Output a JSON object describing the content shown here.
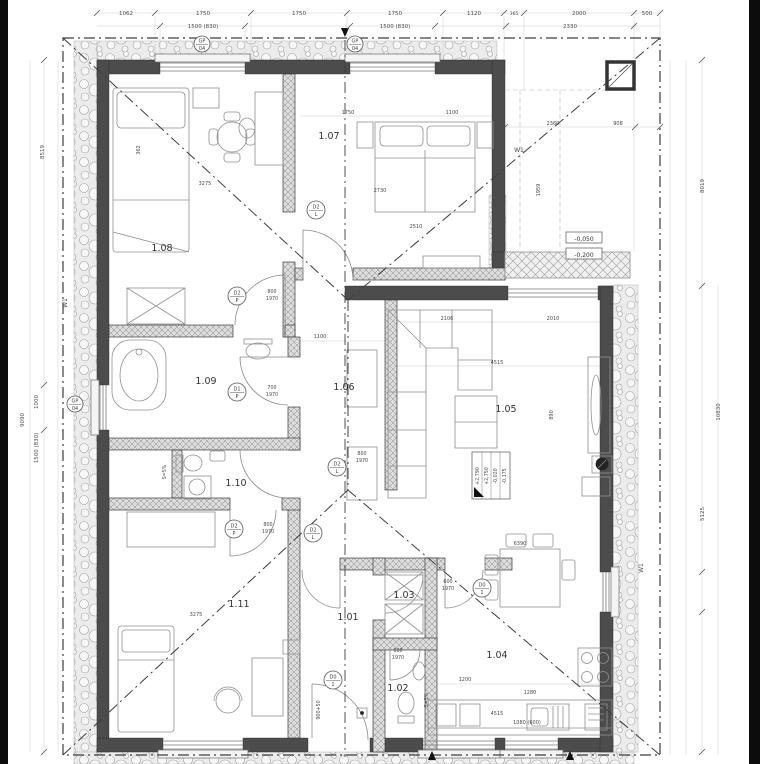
{
  "drawing": {
    "type": "floor-plan",
    "scale_note": ""
  },
  "rooms": [
    {
      "t": "1.01",
      "x": 348,
      "y": 620
    },
    {
      "t": "1.02",
      "x": 398,
      "y": 691
    },
    {
      "t": "1.03",
      "x": 404,
      "y": 598
    },
    {
      "t": "1.04",
      "x": 497,
      "y": 658
    },
    {
      "t": "1.05",
      "x": 506,
      "y": 412
    },
    {
      "t": "1.06",
      "x": 344,
      "y": 390
    },
    {
      "t": "1.07",
      "x": 329,
      "y": 139
    },
    {
      "t": "1.08",
      "x": 162,
      "y": 251
    },
    {
      "t": "1.09",
      "x": 206,
      "y": 384
    },
    {
      "t": "1.10",
      "x": 236,
      "y": 486
    },
    {
      "t": "1.11",
      "x": 239,
      "y": 607
    }
  ],
  "dims": {
    "top1": [
      {
        "t": "1062",
        "x": 126,
        "y": 15
      },
      {
        "t": "1750",
        "x": 203,
        "y": 15
      },
      {
        "t": "1750",
        "x": 299,
        "y": 15
      },
      {
        "t": "1750",
        "x": 395,
        "y": 15
      },
      {
        "t": "1120",
        "x": 474,
        "y": 15
      },
      {
        "t": "365",
        "x": 514,
        "y": 15,
        "fs": 4.5
      },
      {
        "t": "2000",
        "x": 579,
        "y": 15
      },
      {
        "t": "500",
        "x": 647,
        "y": 15
      }
    ],
    "top2": [
      {
        "t": "1500 (830)",
        "x": 203,
        "y": 28
      },
      {
        "t": "1500 (830)",
        "x": 395,
        "y": 28
      },
      {
        "t": "2330",
        "x": 570,
        "y": 28
      }
    ],
    "left": [
      {
        "t": "8519",
        "x": 44,
        "y": 152,
        "r": -90
      },
      {
        "t": "9090",
        "x": 24,
        "y": 420,
        "r": -90
      },
      {
        "t": "1000",
        "x": 38,
        "y": 402,
        "r": -90
      },
      {
        "t": "1500 (830)",
        "x": 38,
        "y": 448,
        "r": -90
      }
    ],
    "right": [
      {
        "t": "8019",
        "x": 704,
        "y": 186,
        "r": -90
      },
      {
        "t": "10830",
        "x": 720,
        "y": 412,
        "r": -90
      },
      {
        "t": "5125",
        "x": 704,
        "y": 514,
        "r": -90
      }
    ],
    "inline": [
      {
        "t": "3275",
        "x": 205,
        "y": 185
      },
      {
        "t": "3275",
        "x": 196,
        "y": 616
      },
      {
        "t": "2510",
        "x": 416,
        "y": 228
      },
      {
        "t": "1750",
        "x": 348,
        "y": 114
      },
      {
        "t": "1100",
        "x": 452,
        "y": 114
      },
      {
        "t": "2730",
        "x": 380,
        "y": 192
      },
      {
        "t": "2360",
        "x": 553,
        "y": 125
      },
      {
        "t": "908",
        "x": 618,
        "y": 125
      },
      {
        "t": "1959",
        "x": 540,
        "y": 190,
        "r": -90
      },
      {
        "t": "2106",
        "x": 447,
        "y": 320
      },
      {
        "t": "2010",
        "x": 553,
        "y": 320
      },
      {
        "t": "4515",
        "x": 497,
        "y": 364
      },
      {
        "t": "4515",
        "x": 497,
        "y": 715
      },
      {
        "t": "6390",
        "x": 520,
        "y": 545
      },
      {
        "t": "1080 (600)",
        "x": 527,
        "y": 724
      },
      {
        "t": "1100",
        "x": 320,
        "y": 338
      },
      {
        "t": "890",
        "x": 553,
        "y": 415,
        "r": -90
      },
      {
        "t": "1200",
        "x": 465,
        "y": 681
      },
      {
        "t": "1280",
        "x": 530,
        "y": 694
      },
      {
        "t": "362",
        "x": 140,
        "y": 150,
        "r": -90
      }
    ],
    "door_tags": [
      {
        "t": "800",
        "x": 272,
        "y": 293
      },
      {
        "t": "1970",
        "x": 272,
        "y": 300
      },
      {
        "t": "700",
        "x": 272,
        "y": 389
      },
      {
        "t": "1970",
        "x": 272,
        "y": 396
      },
      {
        "t": "800",
        "x": 362,
        "y": 455
      },
      {
        "t": "1970",
        "x": 362,
        "y": 462
      },
      {
        "t": "800",
        "x": 268,
        "y": 526
      },
      {
        "t": "1970",
        "x": 268,
        "y": 533
      },
      {
        "t": "600",
        "x": 448,
        "y": 583
      },
      {
        "t": "1970",
        "x": 448,
        "y": 590
      },
      {
        "t": "600",
        "x": 398,
        "y": 652
      },
      {
        "t": "1970",
        "x": 398,
        "y": 659
      }
    ],
    "misc": [
      {
        "t": "S=5%",
        "x": 166,
        "y": 472,
        "r": -90
      },
      {
        "t": "S=5%",
        "x": 428,
        "y": 700,
        "r": -90
      },
      {
        "t": "900+50",
        "x": 320,
        "y": 710,
        "r": -90
      }
    ]
  },
  "door_circles": [
    {
      "a": "D2",
      "b": "L",
      "x": 316,
      "y": 210
    },
    {
      "a": "D2",
      "b": "P",
      "x": 237,
      "y": 296
    },
    {
      "a": "D1",
      "b": "P",
      "x": 237,
      "y": 392
    },
    {
      "a": "D2",
      "b": "L",
      "x": 337,
      "y": 467
    },
    {
      "a": "D2",
      "b": "P",
      "x": 234,
      "y": 529
    },
    {
      "a": "D2",
      "b": "L",
      "x": 313,
      "y": 533
    },
    {
      "a": "D0",
      "b": "1",
      "x": 482,
      "y": 588
    },
    {
      "a": "D0",
      "b": "1",
      "x": 333,
      "y": 680
    }
  ],
  "gp_circles": [
    {
      "a": "GP",
      "b": "04",
      "x": 202,
      "y": 44
    },
    {
      "a": "GP",
      "b": "04",
      "x": 355,
      "y": 44
    },
    {
      "a": "GP",
      "b": "04",
      "x": 75,
      "y": 404
    }
  ],
  "levels": [
    {
      "t": "-0,050",
      "x": 584,
      "y": 240
    },
    {
      "t": "-0,200",
      "x": 584,
      "y": 256
    }
  ],
  "elevation_table": {
    "values": [
      "+2,790",
      "+2,750",
      "-0,020",
      "-0,175"
    ]
  },
  "w_labels": [
    {
      "t": "W1",
      "x": 67,
      "y": 303,
      "r": -90
    },
    {
      "t": "W1",
      "x": 519,
      "y": 152
    },
    {
      "t": "W1",
      "x": 643,
      "y": 568,
      "r": -90
    }
  ],
  "colors": {
    "wall": "#4c4c4c",
    "paper": "#ffffff",
    "dim": "#4a4a4a",
    "edge": "#0c0c0c"
  }
}
